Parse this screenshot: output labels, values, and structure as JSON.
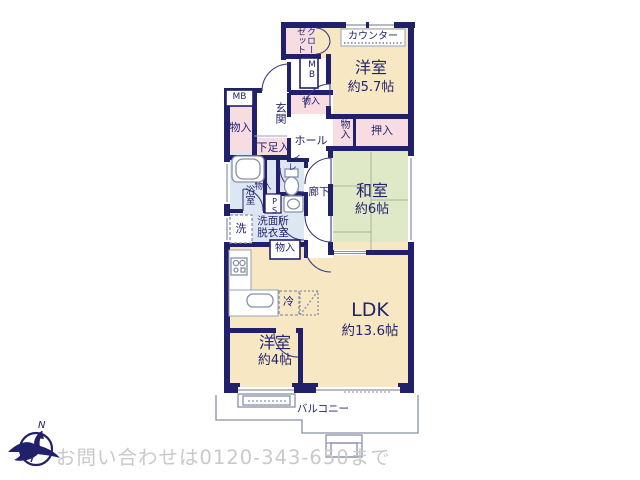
{
  "floorplan": {
    "rooms": {
      "western_57": {
        "name": "洋室",
        "size": "約5.7帖"
      },
      "japanese_6": {
        "name": "和室",
        "size": "約6帖"
      },
      "ldk": {
        "name": "LDK",
        "size": "約13.6帖"
      },
      "western_4": {
        "name": "洋室",
        "size": "約4帖"
      }
    },
    "labels": {
      "counter": "カウンター",
      "closet": "クローゼット",
      "mb": "MB",
      "storage": "物入",
      "entrance": "玄関",
      "hall": "ホール",
      "shoe_box": "下足入",
      "oshiire": "押入",
      "toilet": "トイレ",
      "bath": "浴室",
      "ps": "PS",
      "washroom_line1": "洗面所",
      "washroom_line2": "脱衣室",
      "laundry": "洗",
      "corridor": "廊下",
      "fridge": "冷",
      "balcony": "バルコニー",
      "compass_north": "N"
    },
    "footer": {
      "contact": "お問い合わせは0120-343-650まで"
    },
    "colors": {
      "wall": "#20206b",
      "western_room": "#f7e8c3",
      "japanese_room": "#dfe9c8",
      "closet_pink": "#f7dde2",
      "wet_area": "#dde7f2",
      "fixture_line": "#8890a8",
      "watermark": "#c9c9c9"
    }
  }
}
